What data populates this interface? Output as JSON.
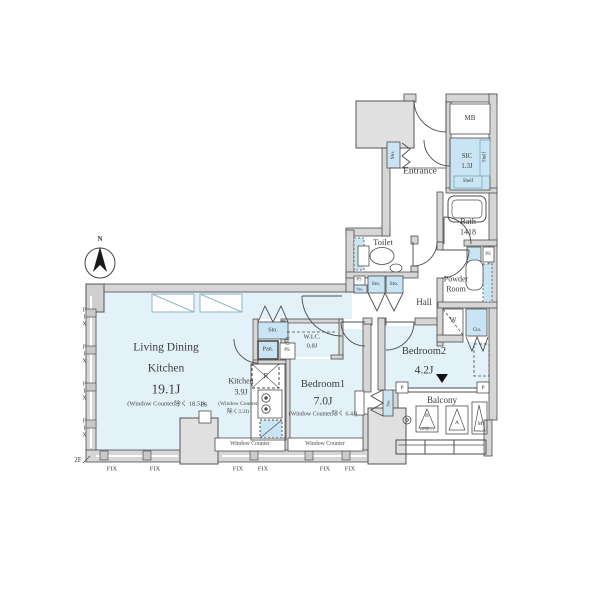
{
  "meta": {
    "floor_label": "2F",
    "compass_north": "N",
    "type": "apartment-floor-plan"
  },
  "colors": {
    "room_fill": "#e3f1f9",
    "closet_fill": "#c9e4f2",
    "wall_fill": "#d6d6d6",
    "line": "#4d4d4d",
    "accent_border": "#7aa7bf"
  },
  "labels": {
    "ldk1": "Living Dining",
    "ldk2": "Kitchen",
    "ldk_size": "19.1J",
    "ldk_note": "(Window Counter除く 18.5J)",
    "kitchen": "Kitchen",
    "kitchen_size": "3.9J",
    "kitchen_note1": "(Window Counter",
    "kitchen_note2": "除く3.3J)",
    "bedroom1": "Bedroom1",
    "bedroom1_size": "7.0J",
    "bedroom1_note": "(Window Counter除く 6.4J)",
    "bedroom2": "Bedroom2",
    "bedroom2_size": "4.2J",
    "wic": "W.I.C.",
    "wic_size": "0.8J",
    "wic_side": "(M)",
    "sic": "SIC",
    "sic_size": "1.3J",
    "shelf": "Shelf",
    "entrance": "Entrance",
    "hall": "Hall",
    "toilet": "Toilet",
    "bath": "Bath",
    "bath_size": "1418",
    "powder1": "Powder",
    "powder2": "Room",
    "balcony": "Balcony",
    "mb": "MB",
    "ps": "PS",
    "sto": "Sto.",
    "pan": "Pan.",
    "clo": "Clo.",
    "w": "W",
    "r": "R",
    "p": "P",
    "unit_b": "B",
    "unit_b_note": "(2F除く)",
    "unit_a": "A",
    "unit_m": "M",
    "window_counter": "Window Counter",
    "fix": "FIX",
    "floor": "2F",
    "north": "N"
  }
}
